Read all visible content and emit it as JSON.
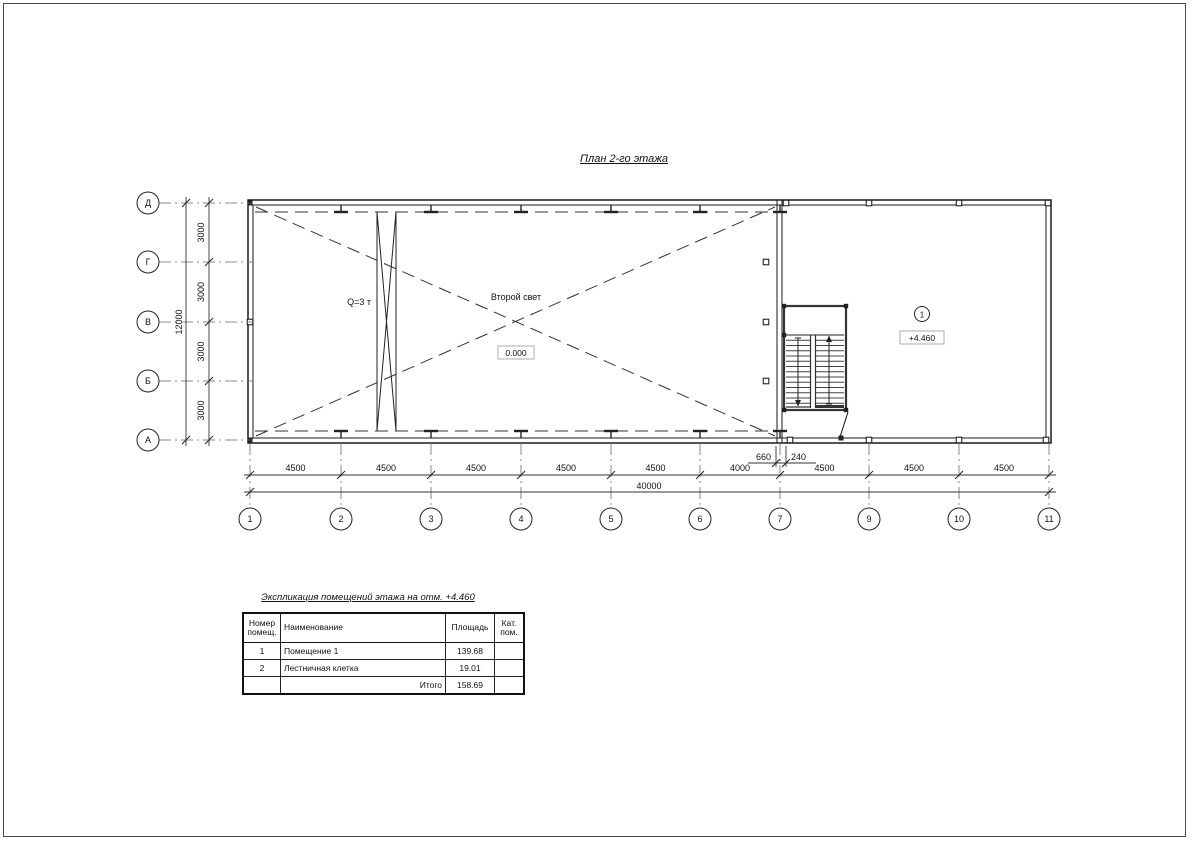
{
  "page": {
    "title": "План 2-го этажа"
  },
  "plan": {
    "labels": {
      "crane": "Q=3 т",
      "void": "Второй свет",
      "level_zero": "0.000",
      "room_tag": "1",
      "room_level": "+4.460"
    },
    "grid": {
      "rows": [
        "Д",
        "Г",
        "В",
        "Б",
        "А"
      ],
      "cols": [
        "1",
        "2",
        "3",
        "4",
        "5",
        "6",
        "7",
        "9",
        "10",
        "11"
      ]
    },
    "dimensions": {
      "row_segments": [
        "3000",
        "3000",
        "3000",
        "3000"
      ],
      "row_total": "12000",
      "col_segments": [
        "4500",
        "4500",
        "4500",
        "4500",
        "4500",
        "4000",
        "4500",
        "4500",
        "4500"
      ],
      "col_total": "40000",
      "detail_left": "660",
      "detail_right": "240"
    }
  },
  "schedule": {
    "title": "Экспликация помещений этажа на отм. +4.460",
    "columns": [
      "Номер помещ.",
      "Наименование",
      "Площадь",
      "Кат. пом."
    ],
    "rows": [
      {
        "num": "1",
        "name": "Помещение 1",
        "area": "139.68",
        "cat": ""
      },
      {
        "num": "2",
        "name": "Лестничная клетка",
        "area": "19.01",
        "cat": ""
      },
      {
        "num": "",
        "name": "Итого",
        "area": "158.69",
        "cat": ""
      }
    ]
  }
}
